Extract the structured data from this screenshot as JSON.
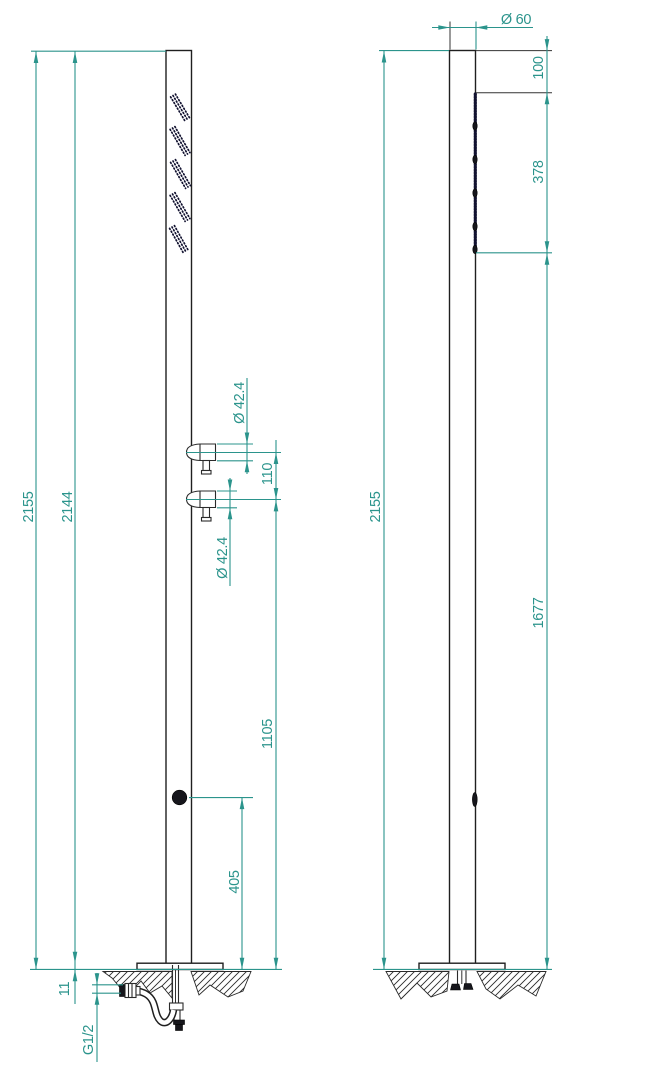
{
  "drawing": {
    "kind": "technical-drawing",
    "subject": "outdoor shower column, front and side elevation with dimensions"
  },
  "front_view": {
    "labels": {
      "total_height": "2155",
      "height_to_plate": "2144",
      "plate_thickness": "11",
      "inlet_thread": "G1/2",
      "upper_handle_diameter": "Ø 42.4",
      "lower_handle_diameter": "Ø 42.4",
      "handle_spacing": "110",
      "handles_height": "1105",
      "knob_height": "405"
    }
  },
  "side_view": {
    "labels": {
      "column_diameter": "Ø 60",
      "head_top_offset": "100",
      "nozzle_strip_length": "378",
      "nozzle_bottom_height": "1677",
      "total_height": "2155"
    }
  },
  "colors": {
    "dimension_teal": "#2b948c",
    "outline_black": "#1f1f1f",
    "nozzle_dark": "#121230",
    "background": "#ffffff"
  }
}
